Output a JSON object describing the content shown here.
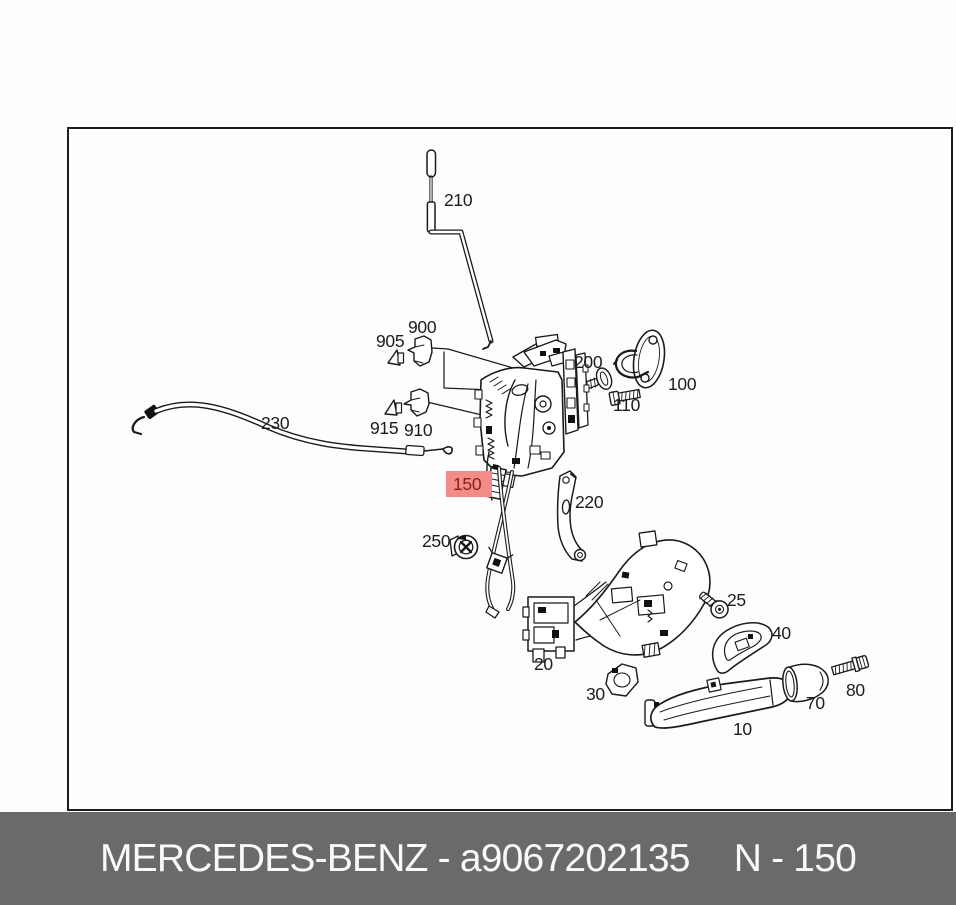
{
  "caption": {
    "left_text": "MERCEDES-BENZ - a9067202135",
    "right_text": "N - 150",
    "bar_color": "#6a6a6a",
    "text_color": "#fafafa"
  },
  "diagram": {
    "type": "exploded-parts-diagram",
    "line_color": "#1a1a1a",
    "highlight": {
      "background": "#f28c88",
      "text_color": "#8b2017"
    },
    "highlighted_part": "150",
    "labels": [
      {
        "id": "210",
        "x": 444,
        "y": 191
      },
      {
        "id": "900",
        "x": 408,
        "y": 318
      },
      {
        "id": "905",
        "x": 376,
        "y": 332
      },
      {
        "id": "915",
        "x": 370,
        "y": 419
      },
      {
        "id": "910",
        "x": 404,
        "y": 421
      },
      {
        "id": "230",
        "x": 261,
        "y": 414
      },
      {
        "id": "200",
        "x": 574,
        "y": 353
      },
      {
        "id": "100",
        "x": 668,
        "y": 375
      },
      {
        "id": "110",
        "x": 613,
        "y": 396
      },
      {
        "id": "150",
        "x": 446,
        "y": 471,
        "highlighted": true
      },
      {
        "id": "220",
        "x": 575,
        "y": 493
      },
      {
        "id": "250",
        "x": 422,
        "y": 532
      },
      {
        "id": "20",
        "x": 534,
        "y": 655
      },
      {
        "id": "25",
        "x": 727,
        "y": 591
      },
      {
        "id": "40",
        "x": 772,
        "y": 624
      },
      {
        "id": "30",
        "x": 586,
        "y": 685
      },
      {
        "id": "10",
        "x": 733,
        "y": 720
      },
      {
        "id": "70",
        "x": 806,
        "y": 694
      },
      {
        "id": "80",
        "x": 846,
        "y": 681
      }
    ]
  }
}
